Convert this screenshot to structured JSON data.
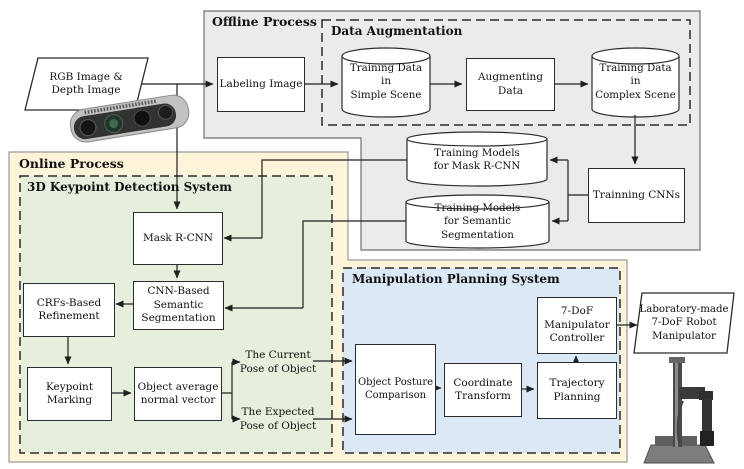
{
  "regions": {
    "offline": {
      "title": "Offline Process"
    },
    "data_augmentation": {
      "title": "Data Augmentation"
    },
    "online": {
      "title": "Online Process"
    },
    "keypoint_system": {
      "title": "3D Keypoint Detection System"
    },
    "manipulation_system": {
      "title": "Manipulation Planning System"
    }
  },
  "nodes": {
    "rgb_input": {
      "lines": [
        "RGB Image &",
        "Depth Image"
      ]
    },
    "labeling": {
      "lines": [
        "Labeling Image"
      ]
    },
    "training_simple": {
      "lines": [
        "Training Data in",
        "Simple Scene"
      ]
    },
    "augmenting": {
      "lines": [
        "Augmenting",
        "Data"
      ]
    },
    "training_complex": {
      "lines": [
        "Training Data in",
        "Complex  Scene"
      ]
    },
    "models_mask": {
      "lines": [
        "Training Models",
        "for Mask R-CNN"
      ]
    },
    "models_semantic": {
      "lines": [
        "Training Models",
        "for Semantic Segmentation"
      ]
    },
    "trainning_cnns": {
      "lines": [
        "Trainning CNNs"
      ]
    },
    "mask_rcnn": {
      "lines": [
        "Mask R-CNN"
      ]
    },
    "cnn_semantic": {
      "lines": [
        "CNN-Based",
        "Semantic",
        "Segmentation"
      ]
    },
    "crfs": {
      "lines": [
        "CRFs-Based",
        "Refinement"
      ]
    },
    "keypoint": {
      "lines": [
        "Keypoint",
        "Marking"
      ]
    },
    "obj_avg": {
      "lines": [
        "Object average",
        "normal vector"
      ]
    },
    "current_pose": {
      "lines": [
        "The Current",
        "Pose of Object"
      ]
    },
    "expected_pose": {
      "lines": [
        "The Expected",
        "Pose of Object"
      ]
    },
    "obj_posture": {
      "lines": [
        "Object Posture",
        "Comparison"
      ]
    },
    "coordinate": {
      "lines": [
        "Coordinate",
        "Transform"
      ]
    },
    "trajectory": {
      "lines": [
        "Trajectory",
        "Planning"
      ]
    },
    "controller": {
      "lines": [
        "7-DoF",
        "Manipulator",
        "Controller"
      ]
    },
    "robot_output": {
      "lines": [
        "Laboratory-made",
        "7-DoF Robot",
        "Manipulator"
      ]
    }
  },
  "colors": {
    "offline_fill": "#ebebeb",
    "online_fill": "#fdf4d9",
    "keypoint_fill": "#e5efdc",
    "manipulation_fill": "#dbe9f6",
    "box_fill": "#ffffff",
    "line": "#1f1f1f"
  }
}
